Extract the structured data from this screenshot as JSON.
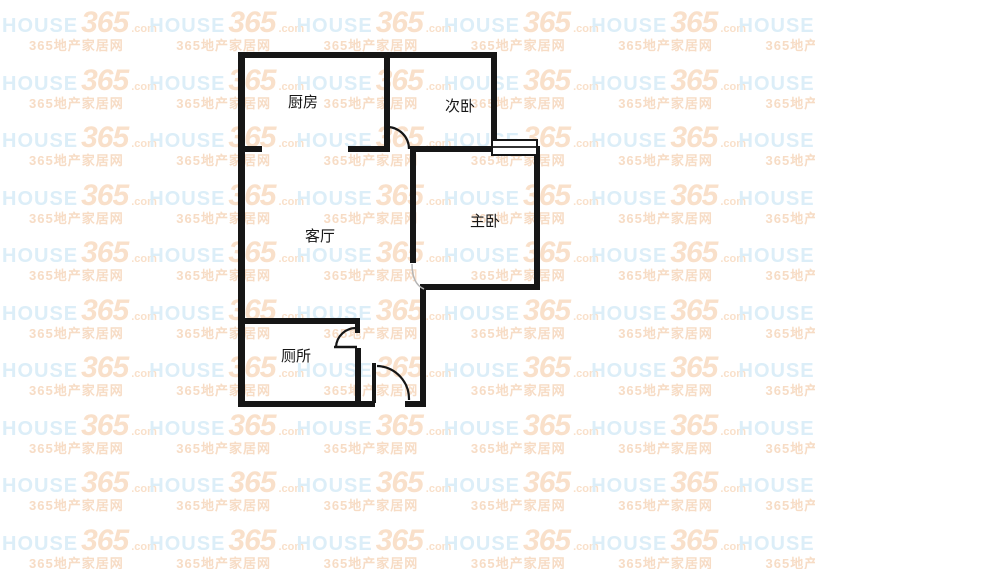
{
  "page": {
    "background": "#ffffff"
  },
  "watermark": {
    "brand": "HOUSE",
    "number": "365",
    "suffix": ".com",
    "tagline": "365地产家居网",
    "colors": {
      "brand": "#dceef8",
      "accent": "#f9e0ca",
      "tagline": "#f7dcc5"
    }
  },
  "floor_plan": {
    "line_color": "#161616",
    "rooms": [
      {
        "id": "kitchen",
        "label": "厨房"
      },
      {
        "id": "bedroom-secondary",
        "label": "次卧"
      },
      {
        "id": "living-room",
        "label": "客厅"
      },
      {
        "id": "bedroom-master",
        "label": "主卧"
      },
      {
        "id": "toilet",
        "label": "厕所"
      }
    ]
  }
}
